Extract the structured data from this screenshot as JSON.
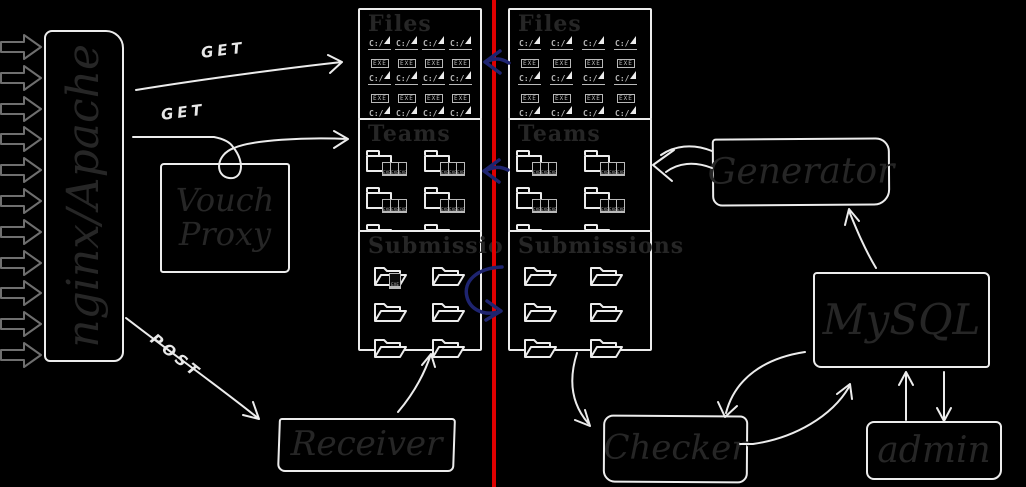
{
  "colors": {
    "background": "#000000",
    "stroke_white": "#ececec",
    "stroke_gray": "#6f6f6f",
    "text_dark": "#262626",
    "navy": "#1e2470",
    "red": "#df0000",
    "icon_gray": "#b9b9b9",
    "label_white": "#e8e8e8"
  },
  "left_traffic": {
    "count": 11
  },
  "nodes": {
    "proxy": {
      "label": "nginx/Apache"
    },
    "vouch": {
      "label": "Vouch Proxy"
    },
    "receiver": {
      "label": "Receiver"
    },
    "generator": {
      "label": "Generator"
    },
    "mysql": {
      "label": "MySQL"
    },
    "checker": {
      "label": "Checker"
    },
    "admin": {
      "label": "admin"
    }
  },
  "edge_labels": {
    "get_files": "GET",
    "get_teams": "GET",
    "post": "POST"
  },
  "storage": {
    "left": {
      "files": {
        "title": "Files",
        "count": 12
      },
      "teams": {
        "title": "Teams",
        "count": 6
      },
      "submissions": {
        "title": "Submissio",
        "count": 6,
        "attachment_index": 0
      }
    },
    "right": {
      "files": {
        "title": "Files",
        "count": 12
      },
      "teams": {
        "title": "Teams",
        "count": 6
      },
      "submissions": {
        "title": "Submissions",
        "count": 6
      }
    }
  },
  "icons": {
    "exe_prefix": "C:/",
    "exe_label": "EXE"
  }
}
